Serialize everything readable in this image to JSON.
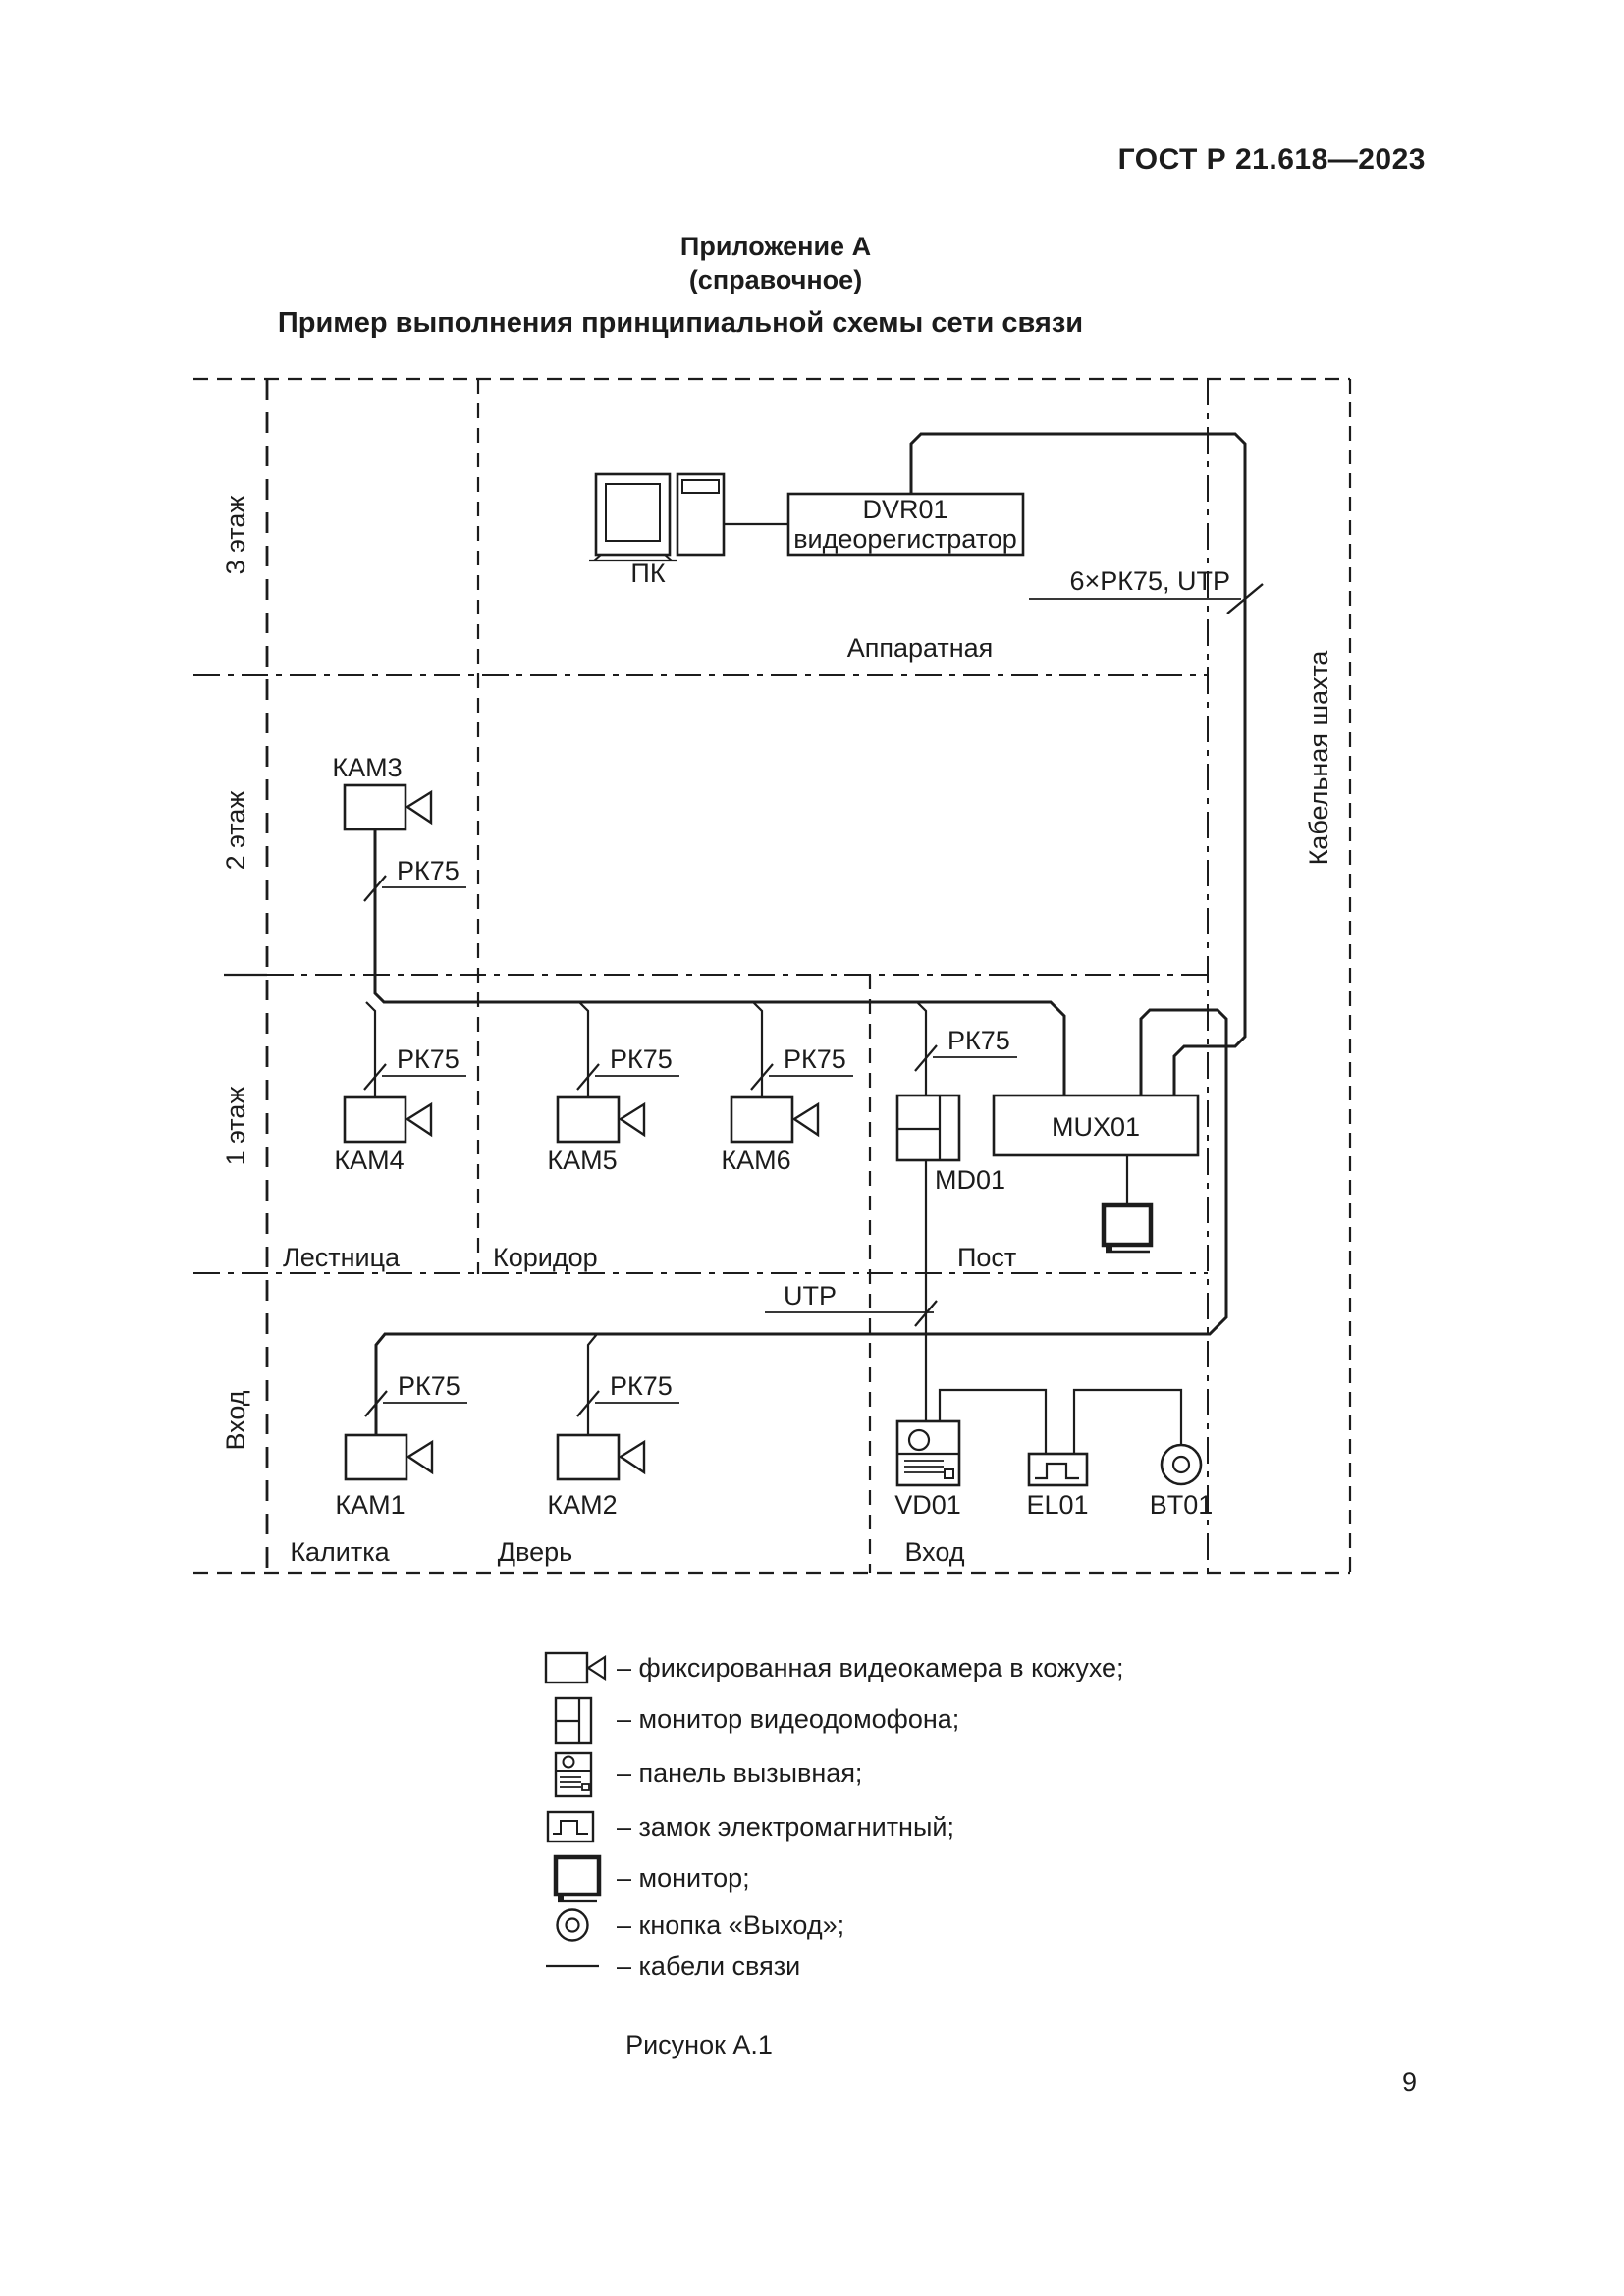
{
  "page": {
    "standard": "ГОСТ Р 21.618—2023",
    "page_number": "9",
    "figure_caption": "Рисунок А.1"
  },
  "header": {
    "appendix": "Приложение А",
    "appendix_note": "(справочное)",
    "title": "Пример выполнения принципиальной схемы сети связи"
  },
  "diagram": {
    "floors": {
      "floor3": "3 этаж",
      "floor2": "2 этаж",
      "floor1": "1 этаж",
      "entrance": "Вход"
    },
    "rooms": {
      "hardware_room": "Аппаратная",
      "stairs": "Лестница",
      "corridor": "Коридор",
      "post": "Пост",
      "gate": "Калитка",
      "door": "Дверь",
      "entrance": "Вход",
      "cable_shaft": "Кабельная шахта"
    },
    "devices": {
      "pc": "ПК",
      "dvr_name": "DVR01",
      "dvr_type": "видеорегистратор",
      "mux": "MUX01",
      "md": "MD01",
      "vd": "VD01",
      "el": "EL01",
      "bt": "BT01",
      "cam1": "КАМ1",
      "cam2": "КАМ2",
      "cam3": "КАМ3",
      "cam4": "КАМ4",
      "cam5": "КАМ5",
      "cam6": "КАМ6"
    },
    "cables": {
      "rk75": "РК75",
      "utp": "UTP",
      "trunk": "6×РК75, UTP"
    }
  },
  "legend": {
    "items": [
      {
        "icon": "fixed-camera-icon",
        "label": "– фиксированная видеокамера в кожухе;"
      },
      {
        "icon": "intercom-monitor-icon",
        "label": "– монитор видеодомофона;"
      },
      {
        "icon": "call-panel-icon",
        "label": "– панель вызывная;"
      },
      {
        "icon": "electromagnetic-lock-icon",
        "label": "– замок электромагнитный;"
      },
      {
        "icon": "monitor-icon",
        "label": "– монитор;"
      },
      {
        "icon": "exit-button-icon",
        "label": "– кнопка «Выход»;"
      },
      {
        "icon": "cable-line-icon",
        "label": "– кабели связи"
      }
    ]
  },
  "colors": {
    "ink": "#1c1c1c",
    "paper": "#ffffff"
  }
}
